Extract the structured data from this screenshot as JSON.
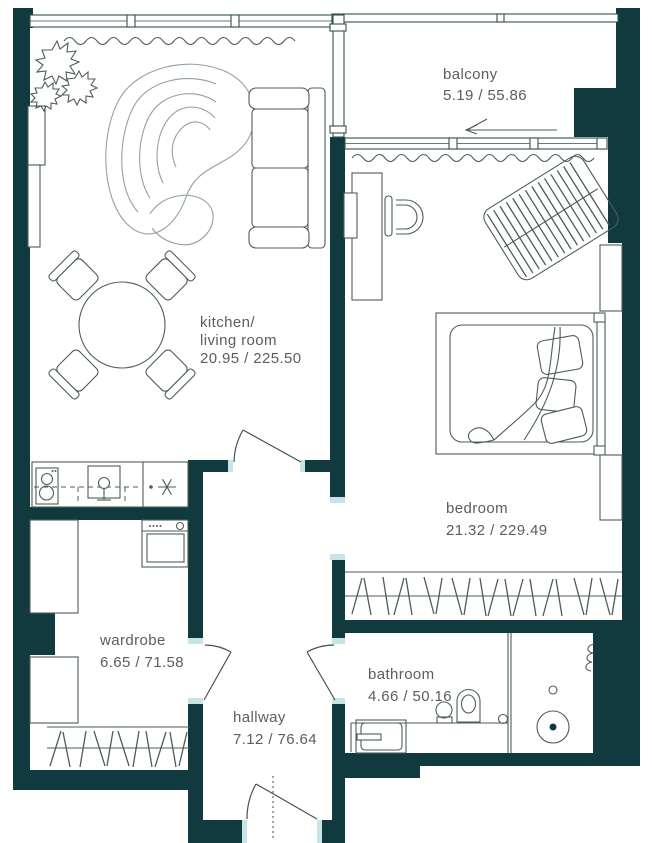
{
  "plan": {
    "rooms": [
      {
        "name": "balcony",
        "label": "balcony",
        "area": "5.19 / 55.86"
      },
      {
        "name": "kitchen-living-room",
        "label_line1": "kitchen/",
        "label_line2": "living room",
        "area": "20.95 / 225.50"
      },
      {
        "name": "bedroom",
        "label": "bedroom",
        "area": "21.32 / 229.49"
      },
      {
        "name": "wardrobe",
        "label": "wardrobe",
        "area": "6.65 / 71.58"
      },
      {
        "name": "hallway",
        "label": "hallway",
        "area": "7.12 / 76.64"
      },
      {
        "name": "bathroom",
        "label": "bathroom",
        "area": "4.66 / 50.16"
      }
    ],
    "colors": {
      "wall": "#103a3e",
      "accent_light": "#c9e4e6",
      "line": "#4e5d5a",
      "text": "#585f5e",
      "background": "#ffffff"
    },
    "symbols": [
      "sofa",
      "rug",
      "plant",
      "dining-table",
      "dining-chair",
      "kitchen-counter",
      "stove",
      "kitchen-sink",
      "ceiling-light",
      "washing-machine",
      "cabinet",
      "clothes-rail",
      "bed",
      "pillows",
      "desk",
      "desk-chair",
      "lounge-chair",
      "curtain",
      "bathtub",
      "washbasin",
      "toilet",
      "shower-drain",
      "towel-radiator",
      "door-swing",
      "window",
      "entry-door",
      "balcony-slide-arrow"
    ]
  }
}
